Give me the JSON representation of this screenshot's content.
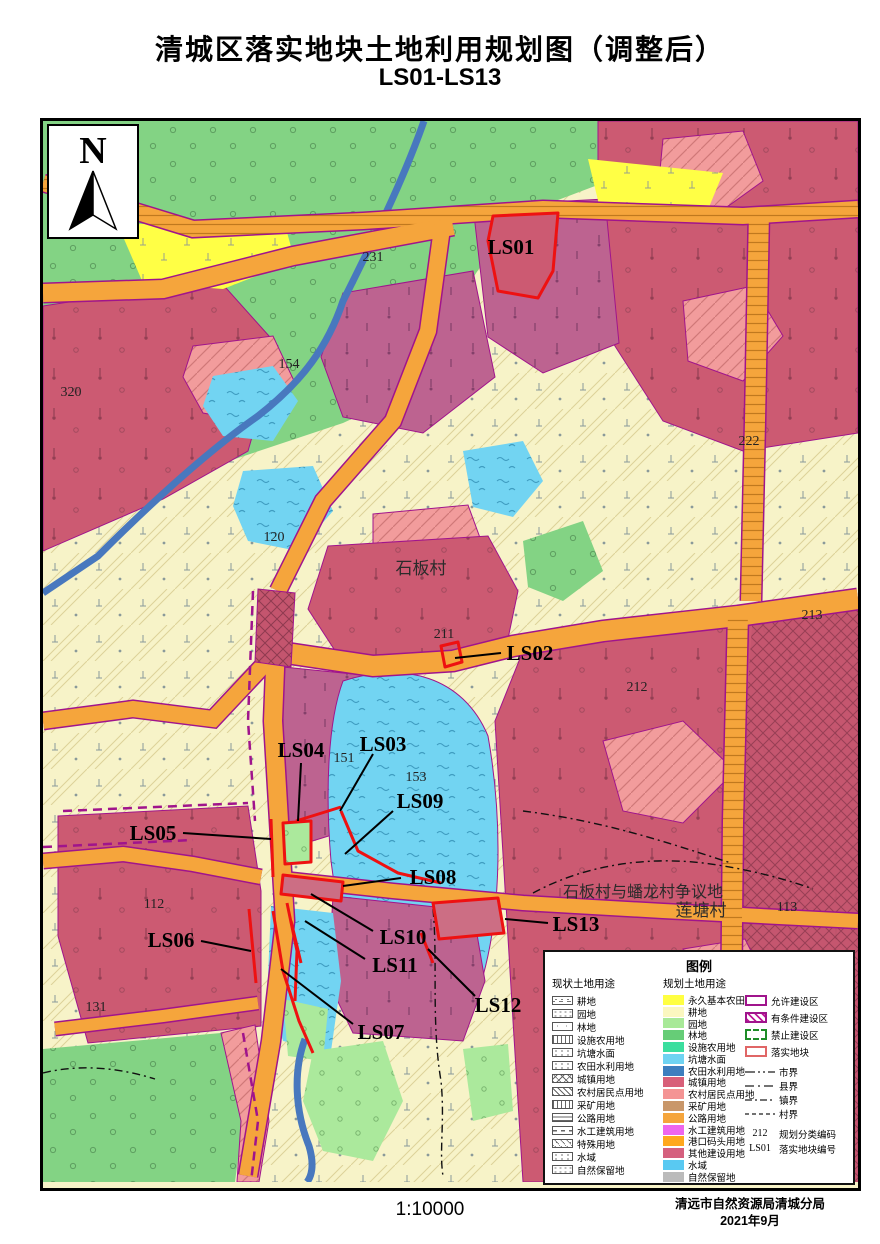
{
  "title": "清城区落实地块土地利用规划图（调整后）",
  "subtitle": "LS01-LS13",
  "scale": "1:10000",
  "attribution": {
    "agency": "清远市自然资源局清城分局",
    "date": "2021年9月"
  },
  "north_label": "N",
  "map_labels": {
    "villages": [
      {
        "text": "石板村"
      },
      {
        "text": "石板村与蟠龙村争议地"
      },
      {
        "text": "莲塘村"
      }
    ],
    "parcels": [
      {
        "id": "LS01"
      },
      {
        "id": "LS02"
      },
      {
        "id": "LS03"
      },
      {
        "id": "LS04"
      },
      {
        "id": "LS05"
      },
      {
        "id": "LS06"
      },
      {
        "id": "LS07"
      },
      {
        "id": "LS08"
      },
      {
        "id": "LS09"
      },
      {
        "id": "LS10"
      },
      {
        "id": "LS11"
      },
      {
        "id": "LS12"
      },
      {
        "id": "LS13"
      }
    ],
    "codes": [
      {
        "text": "231"
      },
      {
        "text": "320"
      },
      {
        "text": "154"
      },
      {
        "text": "120"
      },
      {
        "text": "222"
      },
      {
        "text": "211"
      },
      {
        "text": "212"
      },
      {
        "text": "213"
      },
      {
        "text": "151"
      },
      {
        "text": "153"
      },
      {
        "text": "112"
      },
      {
        "text": "113"
      },
      {
        "text": "131"
      }
    ]
  },
  "legend": {
    "title": "图例",
    "current_header": "现状土地用途",
    "planned_header": "规划土地用途",
    "current": [
      {
        "label": "耕地",
        "pattern": "dotdash"
      },
      {
        "label": "园地",
        "pattern": "dots"
      },
      {
        "label": "林地",
        "pattern": "sparse"
      },
      {
        "label": "设施农用地",
        "pattern": "vlines"
      },
      {
        "label": "坑塘水面",
        "pattern": "waves"
      },
      {
        "label": "农田水利用地",
        "pattern": "waves"
      },
      {
        "label": "城镇用地",
        "pattern": "cross"
      },
      {
        "label": "农村居民点用地",
        "pattern": "diag"
      },
      {
        "label": "采矿用地",
        "pattern": "vlines"
      },
      {
        "label": "公路用地",
        "pattern": "hlines"
      },
      {
        "label": "水工建筑用地",
        "pattern": "dashes"
      },
      {
        "label": "特殊用地",
        "pattern": "diagdots"
      },
      {
        "label": "水域",
        "pattern": "waves"
      },
      {
        "label": "自然保留地",
        "pattern": "dots"
      }
    ],
    "planned": [
      {
        "label": "永久基本农田",
        "color": "#FFFF42"
      },
      {
        "label": "耕地",
        "color": "#FBF7C0"
      },
      {
        "label": "园地",
        "color": "#A8E998"
      },
      {
        "label": "林地",
        "color": "#66CD77"
      },
      {
        "label": "设施农用地",
        "color": "#3BDE9E"
      },
      {
        "label": "坑塘水面",
        "color": "#6FD3F2"
      },
      {
        "label": "农田水利用地",
        "color": "#3D7EBE"
      },
      {
        "label": "城镇用地",
        "color": "#D85F79"
      },
      {
        "label": "农村居民点用地",
        "color": "#F49494"
      },
      {
        "label": "采矿用地",
        "color": "#C9976A"
      },
      {
        "label": "公路用地",
        "color": "#F5A53C"
      },
      {
        "label": "水工建筑用地",
        "color": "#EE66EE"
      },
      {
        "label": "港口码头用地",
        "color": "#FFA81E"
      },
      {
        "label": "其他建设用地",
        "color": "#D5607E"
      },
      {
        "label": "水域",
        "color": "#59C9F2"
      },
      {
        "label": "自然保留地",
        "color": "#BBBBBB"
      }
    ],
    "zones": [
      {
        "label": "允许建设区",
        "style": "allow"
      },
      {
        "label": "有条件建设区",
        "style": "cond"
      },
      {
        "label": "禁止建设区",
        "style": "forbid"
      },
      {
        "label": "落实地块",
        "style": "parcel"
      }
    ],
    "boundaries": [
      {
        "label": "市界",
        "dash": "10 3 2 3 2 3"
      },
      {
        "label": "县界",
        "dash": "9 4 2 4"
      },
      {
        "label": "镇界",
        "dash": "7 3 2 3"
      },
      {
        "label": "村界",
        "dash": "4 3"
      }
    ],
    "codes": [
      {
        "code": "212",
        "label": "规划分类编码"
      },
      {
        "code": "LS01",
        "label": "落实地块编号"
      }
    ]
  }
}
